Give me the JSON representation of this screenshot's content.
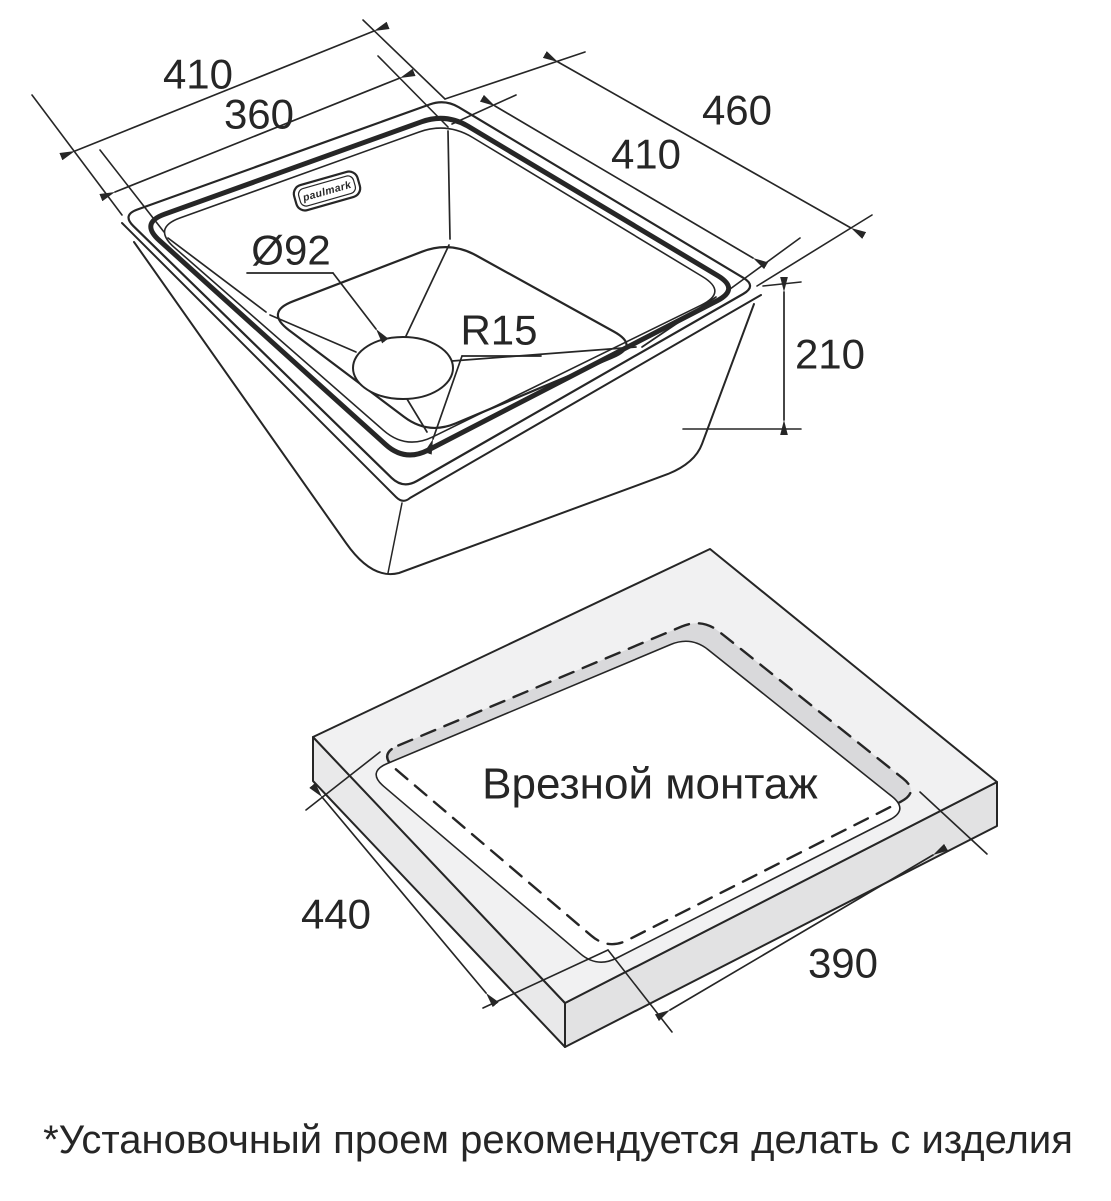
{
  "page": {
    "background": "#ffffff",
    "line_color": "#262626",
    "countertop_top_color": "#f1f1f2",
    "countertop_side_left_color": "#e9e9ea",
    "countertop_side_right_color": "#e2e2e3",
    "cutout_wall_color": "#d9d9db"
  },
  "sink_drawing": {
    "brand_logo_text": "paulmark",
    "dimensions": {
      "rim_width": "410",
      "bowl_width": "360",
      "rim_length": "460",
      "bowl_length": "410",
      "drain_diameter": "Ø92",
      "bowl_corner_radius": "R15",
      "sink_height": "210"
    }
  },
  "cutout_drawing": {
    "title": "Врезной монтаж",
    "dimensions": {
      "cutout_side_left": "440",
      "cutout_side_right": "390"
    }
  },
  "footnote": "*Установочный проем рекомендуется делать с изделия"
}
